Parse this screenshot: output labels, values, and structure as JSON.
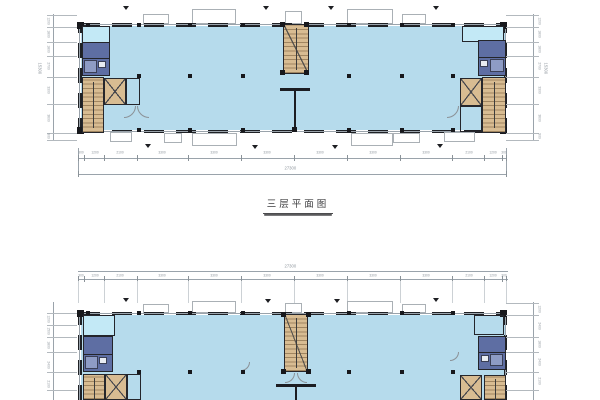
{
  "sheet": {
    "background": "#ffffff",
    "plan_a": {
      "title": "三层平面图"
    },
    "plan_b": {
      "title": ""
    }
  },
  "colors": {
    "floor_fill": "#b6dbec",
    "corner_room_fill": "#c3e9f6",
    "washroom_fill": "#5e6ea3",
    "stair_core_fill": "#d8bc92",
    "wall": "#1f2125",
    "dim_line": "#9aa3ab"
  },
  "dims": {
    "a_bottom": {
      "labels": [
        "300",
        "1200",
        "2100",
        "3300",
        "3300",
        "3300",
        "3300",
        "3300",
        "3300",
        "2100",
        "1200",
        "300"
      ],
      "total": "27300"
    },
    "a_left": {
      "labels": [
        "1200",
        "1800",
        "1800",
        "2700",
        "3300",
        "3600",
        "900"
      ],
      "total": "15300"
    },
    "a_right": {
      "labels": [
        "1200",
        "1800",
        "1800",
        "2700",
        "3300",
        "3600",
        "900"
      ],
      "total": "15300"
    },
    "b_top": {
      "labels": [
        "300",
        "1200",
        "2100",
        "3300",
        "3300",
        "3300",
        "3300",
        "3300",
        "3300",
        "2100",
        "1200",
        "300"
      ],
      "total": "27300"
    },
    "b_left": {
      "labels": [
        "1200",
        "1500",
        "1800",
        "2400",
        "2100"
      ]
    },
    "b_right": {
      "labels": [
        "1200",
        "2400",
        "1800",
        "2400",
        "2100"
      ]
    }
  }
}
